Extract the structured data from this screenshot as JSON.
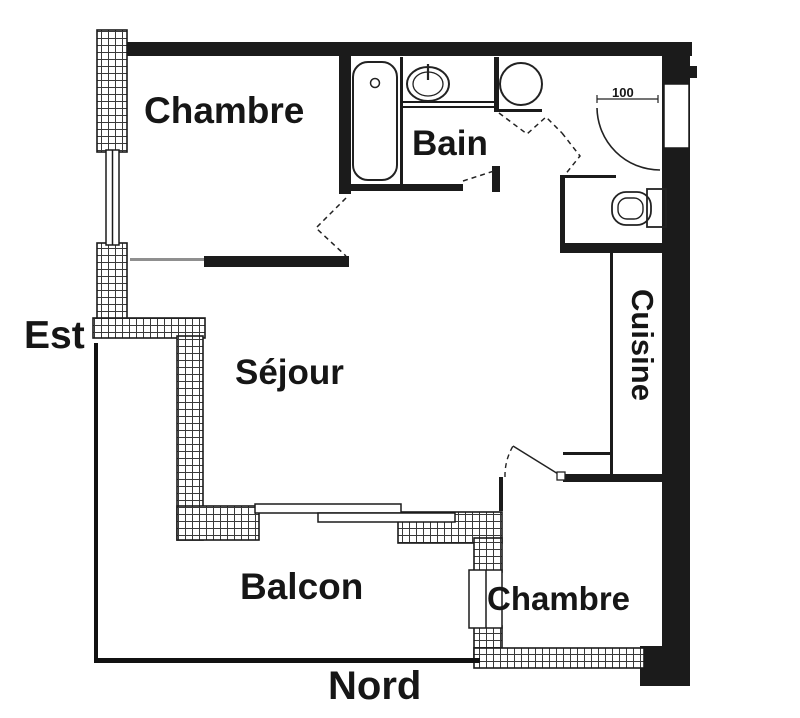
{
  "floorplan": {
    "background": "#ffffff",
    "wall_color": "#1b1b1b",
    "rooms": [
      {
        "id": "chambre-nw",
        "label": "Chambre"
      },
      {
        "id": "bain",
        "label": "Bain"
      },
      {
        "id": "sejour",
        "label": "Séjour"
      },
      {
        "id": "cuisine",
        "label": "Cuisine"
      },
      {
        "id": "balcon",
        "label": "Balcon"
      },
      {
        "id": "chambre-se",
        "label": "Chambre"
      }
    ],
    "orientation": {
      "east": "Est",
      "north": "Nord"
    },
    "entry_door": {
      "width_label": "100"
    },
    "fixtures": [
      "bathtub-icon",
      "washbasin-icon",
      "water-heater-icon",
      "toilet-icon",
      "entry-door-swing-icon",
      "bedroom-door-swing-icon",
      "window-icon",
      "sliding-door-icon",
      "balcony-railing"
    ]
  }
}
